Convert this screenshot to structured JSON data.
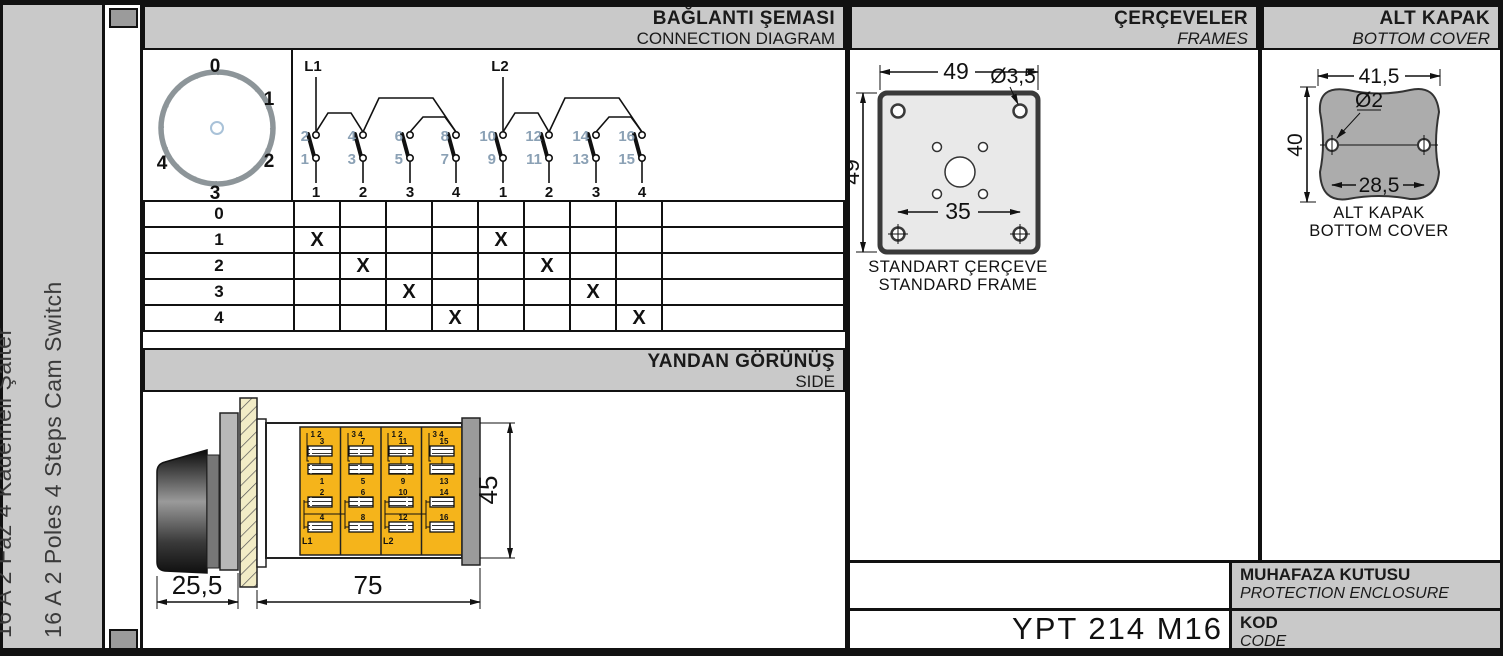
{
  "colors": {
    "header_gray": "#c9c9c9",
    "body_yellow": "#f5b41b",
    "terminal_blue": "#8ba1b5",
    "frame_fill": "#e9e9e9",
    "cover_gray": "#acacac"
  },
  "sidebar": {
    "title_tr": "16 A 2 Faz 4 Kademeli Şalter",
    "title_en": "16 A 2 Poles 4 Steps Cam Switch"
  },
  "connection": {
    "title_tr": "BAĞLANTI ŞEMASI",
    "title_en": "CONNECTION DIAGRAM",
    "dial": {
      "positions": [
        "0",
        "1",
        "2",
        "3",
        "4"
      ]
    },
    "feeds": [
      "L1",
      "L2"
    ],
    "contacts": [
      {
        "top": "2",
        "bottom": "1",
        "step": "1"
      },
      {
        "top": "4",
        "bottom": "3",
        "step": "2"
      },
      {
        "top": "6",
        "bottom": "5",
        "step": "3"
      },
      {
        "top": "8",
        "bottom": "7",
        "step": "4"
      },
      {
        "top": "10",
        "bottom": "9",
        "step": "1"
      },
      {
        "top": "12",
        "bottom": "11",
        "step": "2"
      },
      {
        "top": "14",
        "bottom": "13",
        "step": "3"
      },
      {
        "top": "16",
        "bottom": "15",
        "step": "4"
      }
    ],
    "table": {
      "rows": [
        {
          "label": "0",
          "cells": [
            "",
            "",
            "",
            "",
            "",
            "",
            "",
            "",
            ""
          ]
        },
        {
          "label": "1",
          "cells": [
            "X",
            "",
            "",
            "",
            "X",
            "",
            "",
            "",
            ""
          ]
        },
        {
          "label": "2",
          "cells": [
            "",
            "X",
            "",
            "",
            "",
            "X",
            "",
            "",
            ""
          ]
        },
        {
          "label": "3",
          "cells": [
            "",
            "",
            "X",
            "",
            "",
            "",
            "X",
            "",
            ""
          ]
        },
        {
          "label": "4",
          "cells": [
            "",
            "",
            "",
            "X",
            "",
            "",
            "",
            "X",
            ""
          ]
        }
      ]
    }
  },
  "side_view": {
    "title_tr": "YANDAN GÖRÜNÜŞ",
    "title_en": "SIDE",
    "dims": {
      "knob": "25,5",
      "body": "75",
      "height": "45"
    },
    "sections": [
      {
        "pair": "1 2",
        "upper_top": "3",
        "upper_bottom": "1",
        "lower_top": "2",
        "lower_bottom": "4",
        "feed": "L1"
      },
      {
        "pair": "3 4",
        "upper_top": "7",
        "upper_bottom": "5",
        "lower_top": "6",
        "lower_bottom": "8",
        "feed": ""
      },
      {
        "pair": "1 2",
        "upper_top": "11",
        "upper_bottom": "9",
        "lower_top": "10",
        "lower_bottom": "12",
        "feed": "L2"
      },
      {
        "pair": "3 4",
        "upper_top": "15",
        "upper_bottom": "13",
        "lower_top": "14",
        "lower_bottom": "16",
        "feed": ""
      }
    ]
  },
  "frames": {
    "title_tr": "ÇERÇEVELER",
    "title_en": "FRAMES",
    "dims": {
      "width": "49",
      "height": "49",
      "hole": "Ø3,5",
      "inner": "35"
    },
    "caption_tr": "STANDART ÇERÇEVE",
    "caption_en": "STANDARD FRAME"
  },
  "bottom_cover": {
    "title_tr": "ALT KAPAK",
    "title_en": "BOTTOM COVER",
    "dims": {
      "width": "41,5",
      "hole": "Ø2",
      "height": "40",
      "hole_spacing": "28,5"
    },
    "caption_tr": "ALT KAPAK",
    "caption_en": "BOTTOM COVER"
  },
  "enclosure": {
    "label_tr": "MUHAFAZA KUTUSU",
    "label_en": "PROTECTION ENCLOSURE"
  },
  "code": {
    "label_tr": "KOD",
    "label_en": "CODE",
    "value": "YPT 214 M16"
  }
}
